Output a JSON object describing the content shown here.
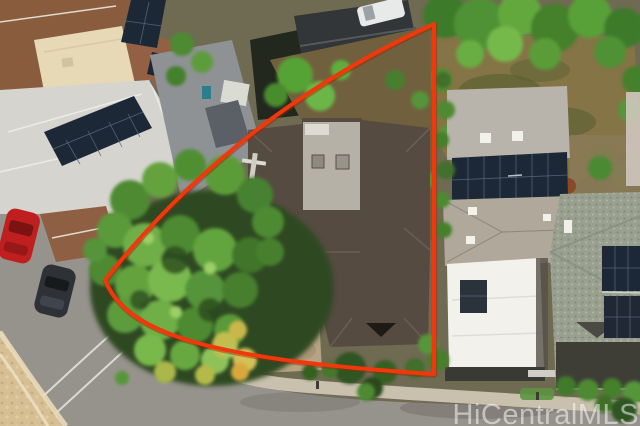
{
  "image": {
    "description": "Aerial drone photograph of a residential lot outlined in red (real-estate listing photo)",
    "width": 640,
    "height": 426
  },
  "watermark": {
    "text": "HiCentralMLS",
    "color": "#ffffff",
    "opacity": "0.52"
  },
  "boundary": {
    "color": "#f2380b",
    "stroke_width": 4,
    "path": "M 434 24 Q 236 114 105 280 C 126 332 202 359 434 374 L 434 24 Z"
  },
  "palette": {
    "road": "#96938c",
    "sidewalk": "#cdc5b2",
    "embankment": "#d7bf94",
    "shingle_roof": "#8a5c3e",
    "beige_roof": "#e7d9b6",
    "light_gray_roof": "#d6d4cf",
    "dark_roof": "#333639",
    "subject_roof": "#564b41",
    "subject_roof_flat": "#b6b1a7",
    "neighbor_gray_roof": "#b8b4ab",
    "gable_roof": "#b0a99b",
    "white_roof": "#f2f1ec",
    "speckled_roof": "#99a08f",
    "solar_panel": "#1d2836",
    "tree_green": "#4e8a30",
    "lawn_dry": "#857445",
    "grass": "#5d9340",
    "dirt": "#71603e",
    "driveway": "#b5a383",
    "red_car": "#bf1f1f",
    "dark_car": "#2e3237",
    "truck_white": "#e8eaea"
  }
}
